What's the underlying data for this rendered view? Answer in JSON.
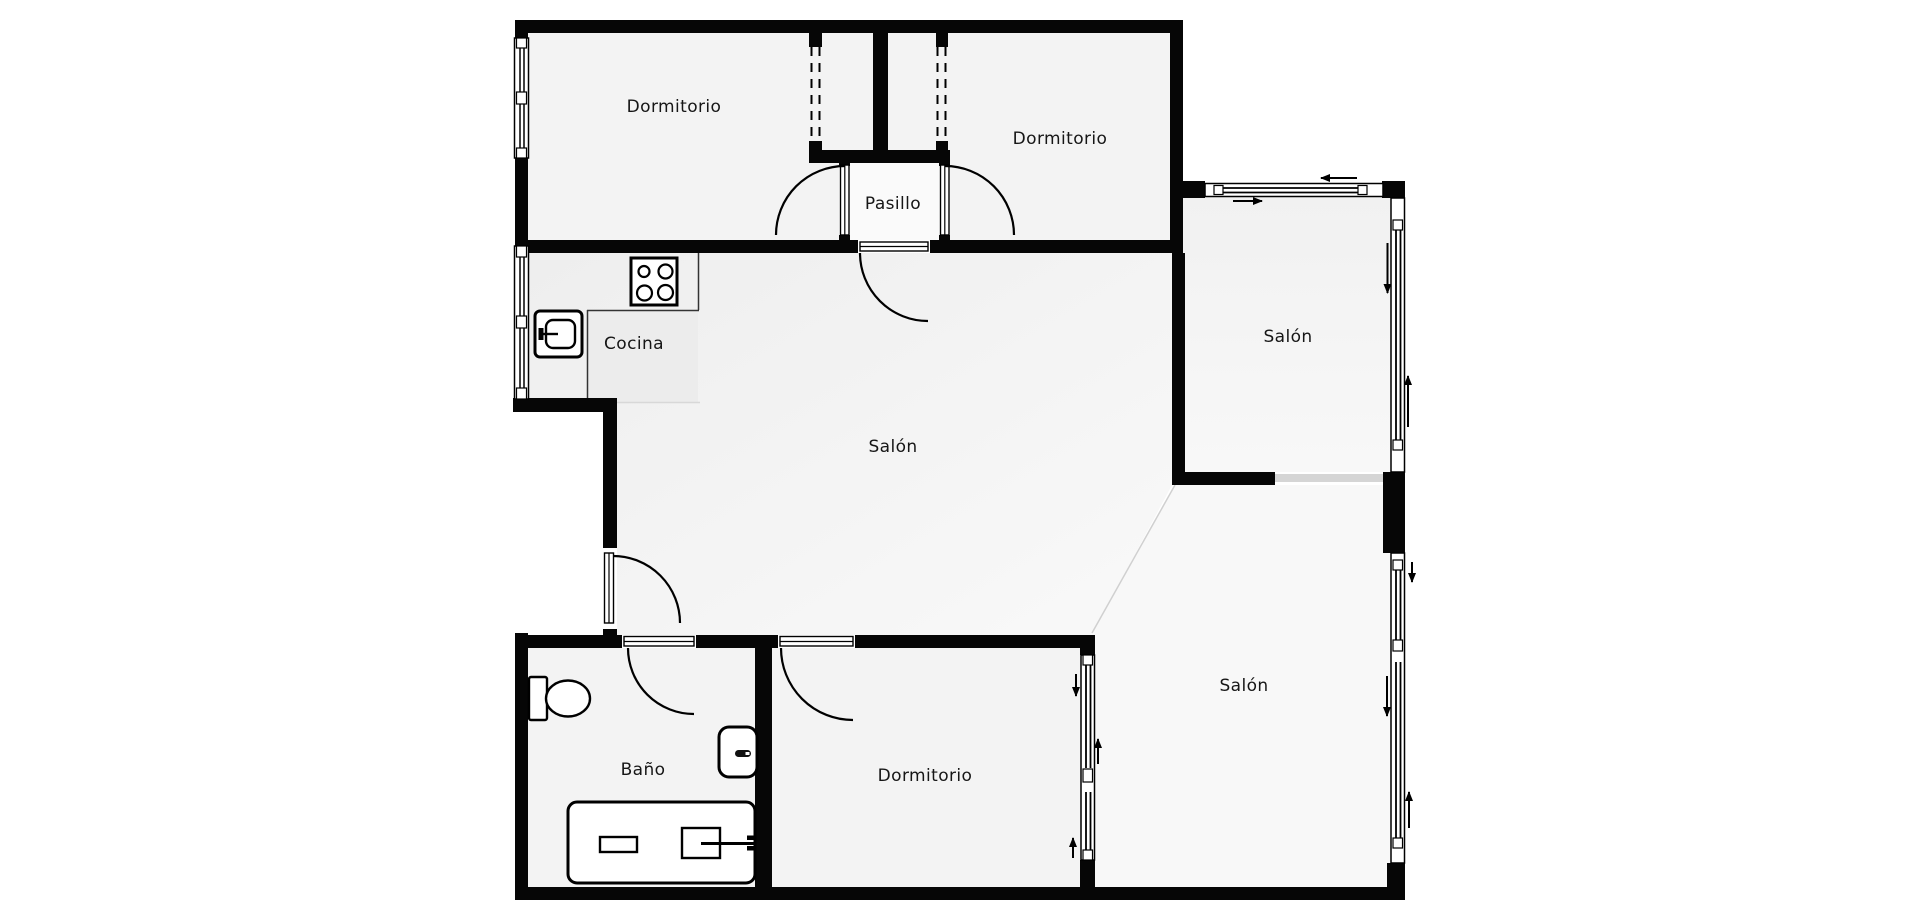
{
  "plan": {
    "type": "apartment-floor-plan",
    "colors": {
      "background": "#ffffff",
      "wall": "#060606",
      "floor": "#f3f3f3",
      "floor_light": "#f9f9f9",
      "kitchen_zone": "#ececec",
      "opening_gray": "#d5d5d5",
      "label_text": "#161616"
    },
    "rooms": [
      {
        "id": "dormitorio-top-left",
        "label": "Dormitorio"
      },
      {
        "id": "dormitorio-top-right",
        "label": "Dormitorio"
      },
      {
        "id": "pasillo",
        "label": "Pasillo"
      },
      {
        "id": "cocina",
        "label": "Cocina"
      },
      {
        "id": "salon-central",
        "label": "Salón"
      },
      {
        "id": "salon-terraza-superior",
        "label": "Salón"
      },
      {
        "id": "salon-terraza-inferior",
        "label": "Salón"
      },
      {
        "id": "bano",
        "label": "Baño"
      },
      {
        "id": "dormitorio-inferior",
        "label": "Dormitorio"
      }
    ],
    "fixtures": [
      "stove-hob-icon",
      "washing-machine-icon",
      "toilet-icon",
      "sink-icon",
      "bathtub-icon"
    ],
    "symbols": [
      "door-swing-arc",
      "window-glazing",
      "closet-dashed-front",
      "sliding-direction-arrow"
    ]
  }
}
